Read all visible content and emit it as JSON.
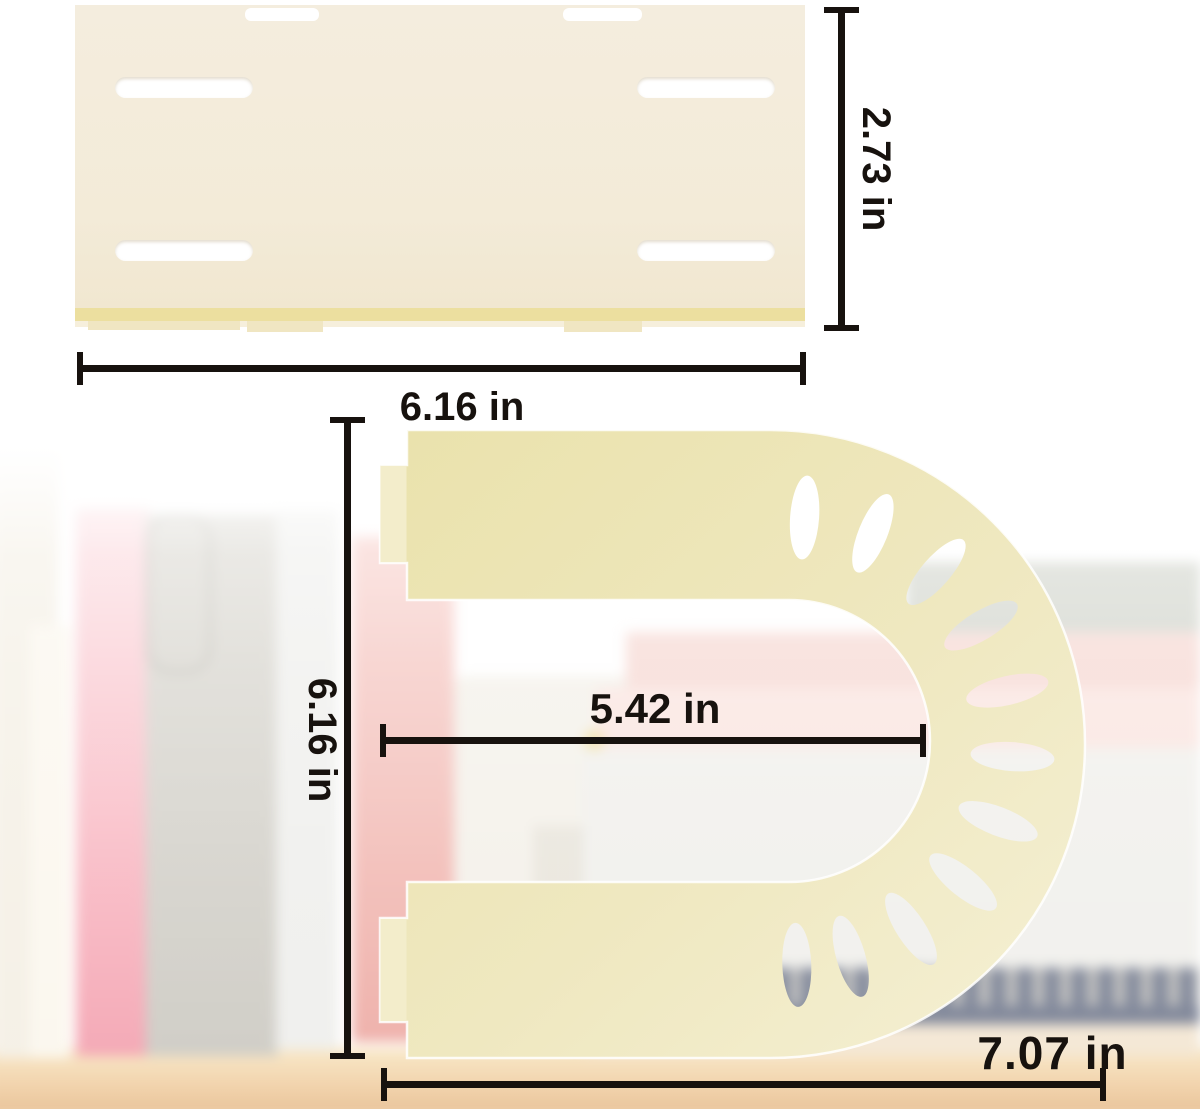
{
  "title": "Bookend divider with base plate — product dimensions",
  "palette": {
    "background": "#ffffff",
    "dimension_ink": "#17120e",
    "plate_body": "#f3ebd8",
    "plate_strip": "#ecdf9f",
    "plate_tab": "#f0e6c2",
    "slot_white": "#ffffff",
    "bookend_dark": "#eae2ac",
    "bookend_mid": "#efe8c0",
    "bookend_light": "#f5f0d4",
    "bookend_tab": "#f3edcb",
    "table_wood": "#eec694"
  },
  "measurements": {
    "plate_width": {
      "label": "6.16 in"
    },
    "plate_height": {
      "label": "2.73 in"
    },
    "bookend_height": {
      "label": "6.16 in"
    },
    "inner_width": {
      "label": "5.42 in"
    },
    "bookend_width": {
      "label": "7.07 in"
    }
  },
  "bookend": {
    "hole_angles_deg": [
      4,
      22,
      41,
      59,
      77,
      94,
      111,
      129,
      147,
      164,
      178
    ],
    "hole_ring": {
      "cx": 789,
      "cy": 741,
      "radius": 224,
      "rx": 14.5,
      "ry": 42
    }
  }
}
